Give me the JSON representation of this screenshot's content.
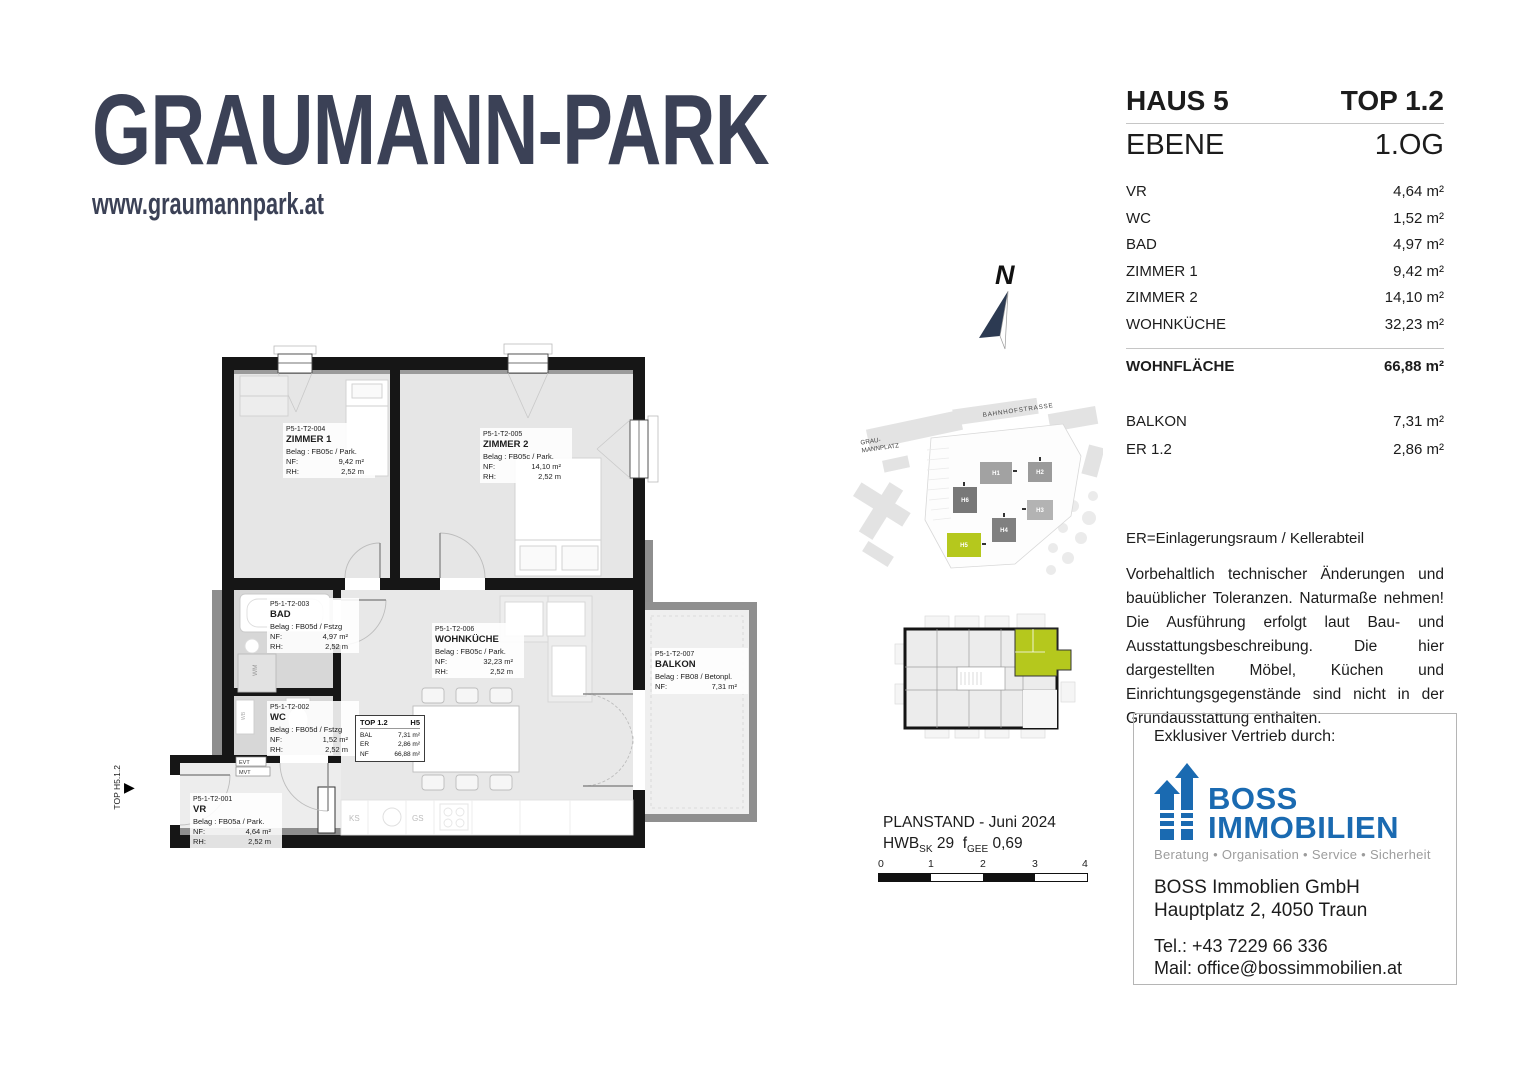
{
  "brand": {
    "logo_text": "GRAUMANN-PARK",
    "website": "www.graumannpark.at"
  },
  "unit_panel": {
    "house_label": "HAUS 5",
    "top_label": "TOP 1.2",
    "level_label": "EBENE",
    "level_value": "1.OG",
    "rooms": [
      {
        "label": "VR",
        "value": "4,64 m²"
      },
      {
        "label": "WC",
        "value": "1,52 m²"
      },
      {
        "label": "BAD",
        "value": "4,97 m²"
      },
      {
        "label": "ZIMMER 1",
        "value": "9,42 m²"
      },
      {
        "label": "ZIMMER 2",
        "value": "14,10 m²"
      },
      {
        "label": "WOHNKÜCHE",
        "value": "32,23 m²"
      }
    ],
    "total_label": "WOHNFLÄCHE",
    "total_value": "66,88 m²",
    "extras": [
      {
        "label": "BALKON",
        "value": "7,31 m²"
      },
      {
        "label": "ER 1.2",
        "value": "2,86 m²"
      }
    ],
    "er_note": "ER=Einlagerungsraum / Kellerabteil",
    "disclaimer": "Vorbehaltlich technischer Änderungen und bauüblicher Toleranzen. Naturmaße nehmen! Die Ausführung erfolgt laut Bau- und Ausstattungsbeschreibung. Die hier dargestellten Möbel, Küchen und Einrichtungsgegenstände sind nicht in der Grundausstattung enthalten."
  },
  "vendor": {
    "heading": "Exklusiver Vertrieb durch:",
    "logo_line1": "BOSS",
    "logo_line2": "IMMOBILIEN",
    "tagline": "Beratung • Organisation • Service • Sicherheit",
    "company": "BOSS Immoblien GmbH",
    "address": "Hauptplatz 2, 4050 Traun",
    "phone": "Tel.: +43 7229 66 336",
    "email": "Mail: office@bossimmobilien.at",
    "brand_color": "#1a6ab1"
  },
  "site_plan": {
    "street": "BAHNHOFSTRASSE",
    "square_line1": "GRAU-",
    "square_line2": "MANNPLATZ",
    "buildings": [
      "H1",
      "H2",
      "H3",
      "H4",
      "H6",
      "H5"
    ],
    "highlight": "H5",
    "highlight_color": "#b5c81d"
  },
  "plan_meta": {
    "compass_n": "N",
    "entry_label": "TOP H5.1.2",
    "planstand": "PLANSTAND - Juni 2024",
    "hwb_label": "HWB",
    "hwb_sub": "SK",
    "hwb_value": "29",
    "fgee_label": "f",
    "fgee_sub": "GEE",
    "fgee_value": "0,69",
    "scale_ticks": [
      "0",
      "1",
      "2",
      "3",
      "4"
    ]
  },
  "floor_plan": {
    "nf_label": "NF:",
    "rh_label": "RH:",
    "rooms": [
      {
        "code": "P5-1-T2-004",
        "name": "ZIMMER 1",
        "belag": "Belag : FB05c / Park.",
        "nf": "9,42 m²",
        "rh": "2,52 m"
      },
      {
        "code": "P5-1-T2-005",
        "name": "ZIMMER 2",
        "belag": "Belag : FB05c / Park.",
        "nf": "14,10 m²",
        "rh": "2,52 m"
      },
      {
        "code": "P5-1-T2-003",
        "name": "BAD",
        "belag": "Belag : FB05d / Fstzg",
        "nf": "4,97 m²",
        "rh": "2,52 m"
      },
      {
        "code": "P5-1-T2-006",
        "name": "WOHNKÜCHE",
        "belag": "Belag : FB05c / Park.",
        "nf": "32,23 m²",
        "rh": "2,52 m"
      },
      {
        "code": "P5-1-T2-002",
        "name": "WC",
        "belag": "Belag : FB05d / Fstzg",
        "nf": "1,52 m²",
        "rh": "2,52 m"
      },
      {
        "code": "P5-1-T2-001",
        "name": "VR",
        "belag": "Belag : FB05a / Park.",
        "nf": "4,64 m²",
        "rh": "2,52 m"
      },
      {
        "code": "P5-1-T2-007",
        "name": "BALKON",
        "belag": "Belag : FB08 / Betonpl.",
        "nf": "7,31 m²"
      }
    ],
    "info_box": {
      "title": "TOP 1.2",
      "house": "H5",
      "rows": [
        {
          "label": "BAL",
          "value": "7,31 m²"
        },
        {
          "label": "ER",
          "value": "2,86 m²"
        },
        {
          "label": "NF",
          "value": "66,88 m²"
        }
      ]
    },
    "small_labels": {
      "wm": "WM",
      "wb": "WB",
      "ks": "KS",
      "gs": "GS",
      "evt": "EVT",
      "mvt": "MVT"
    }
  }
}
